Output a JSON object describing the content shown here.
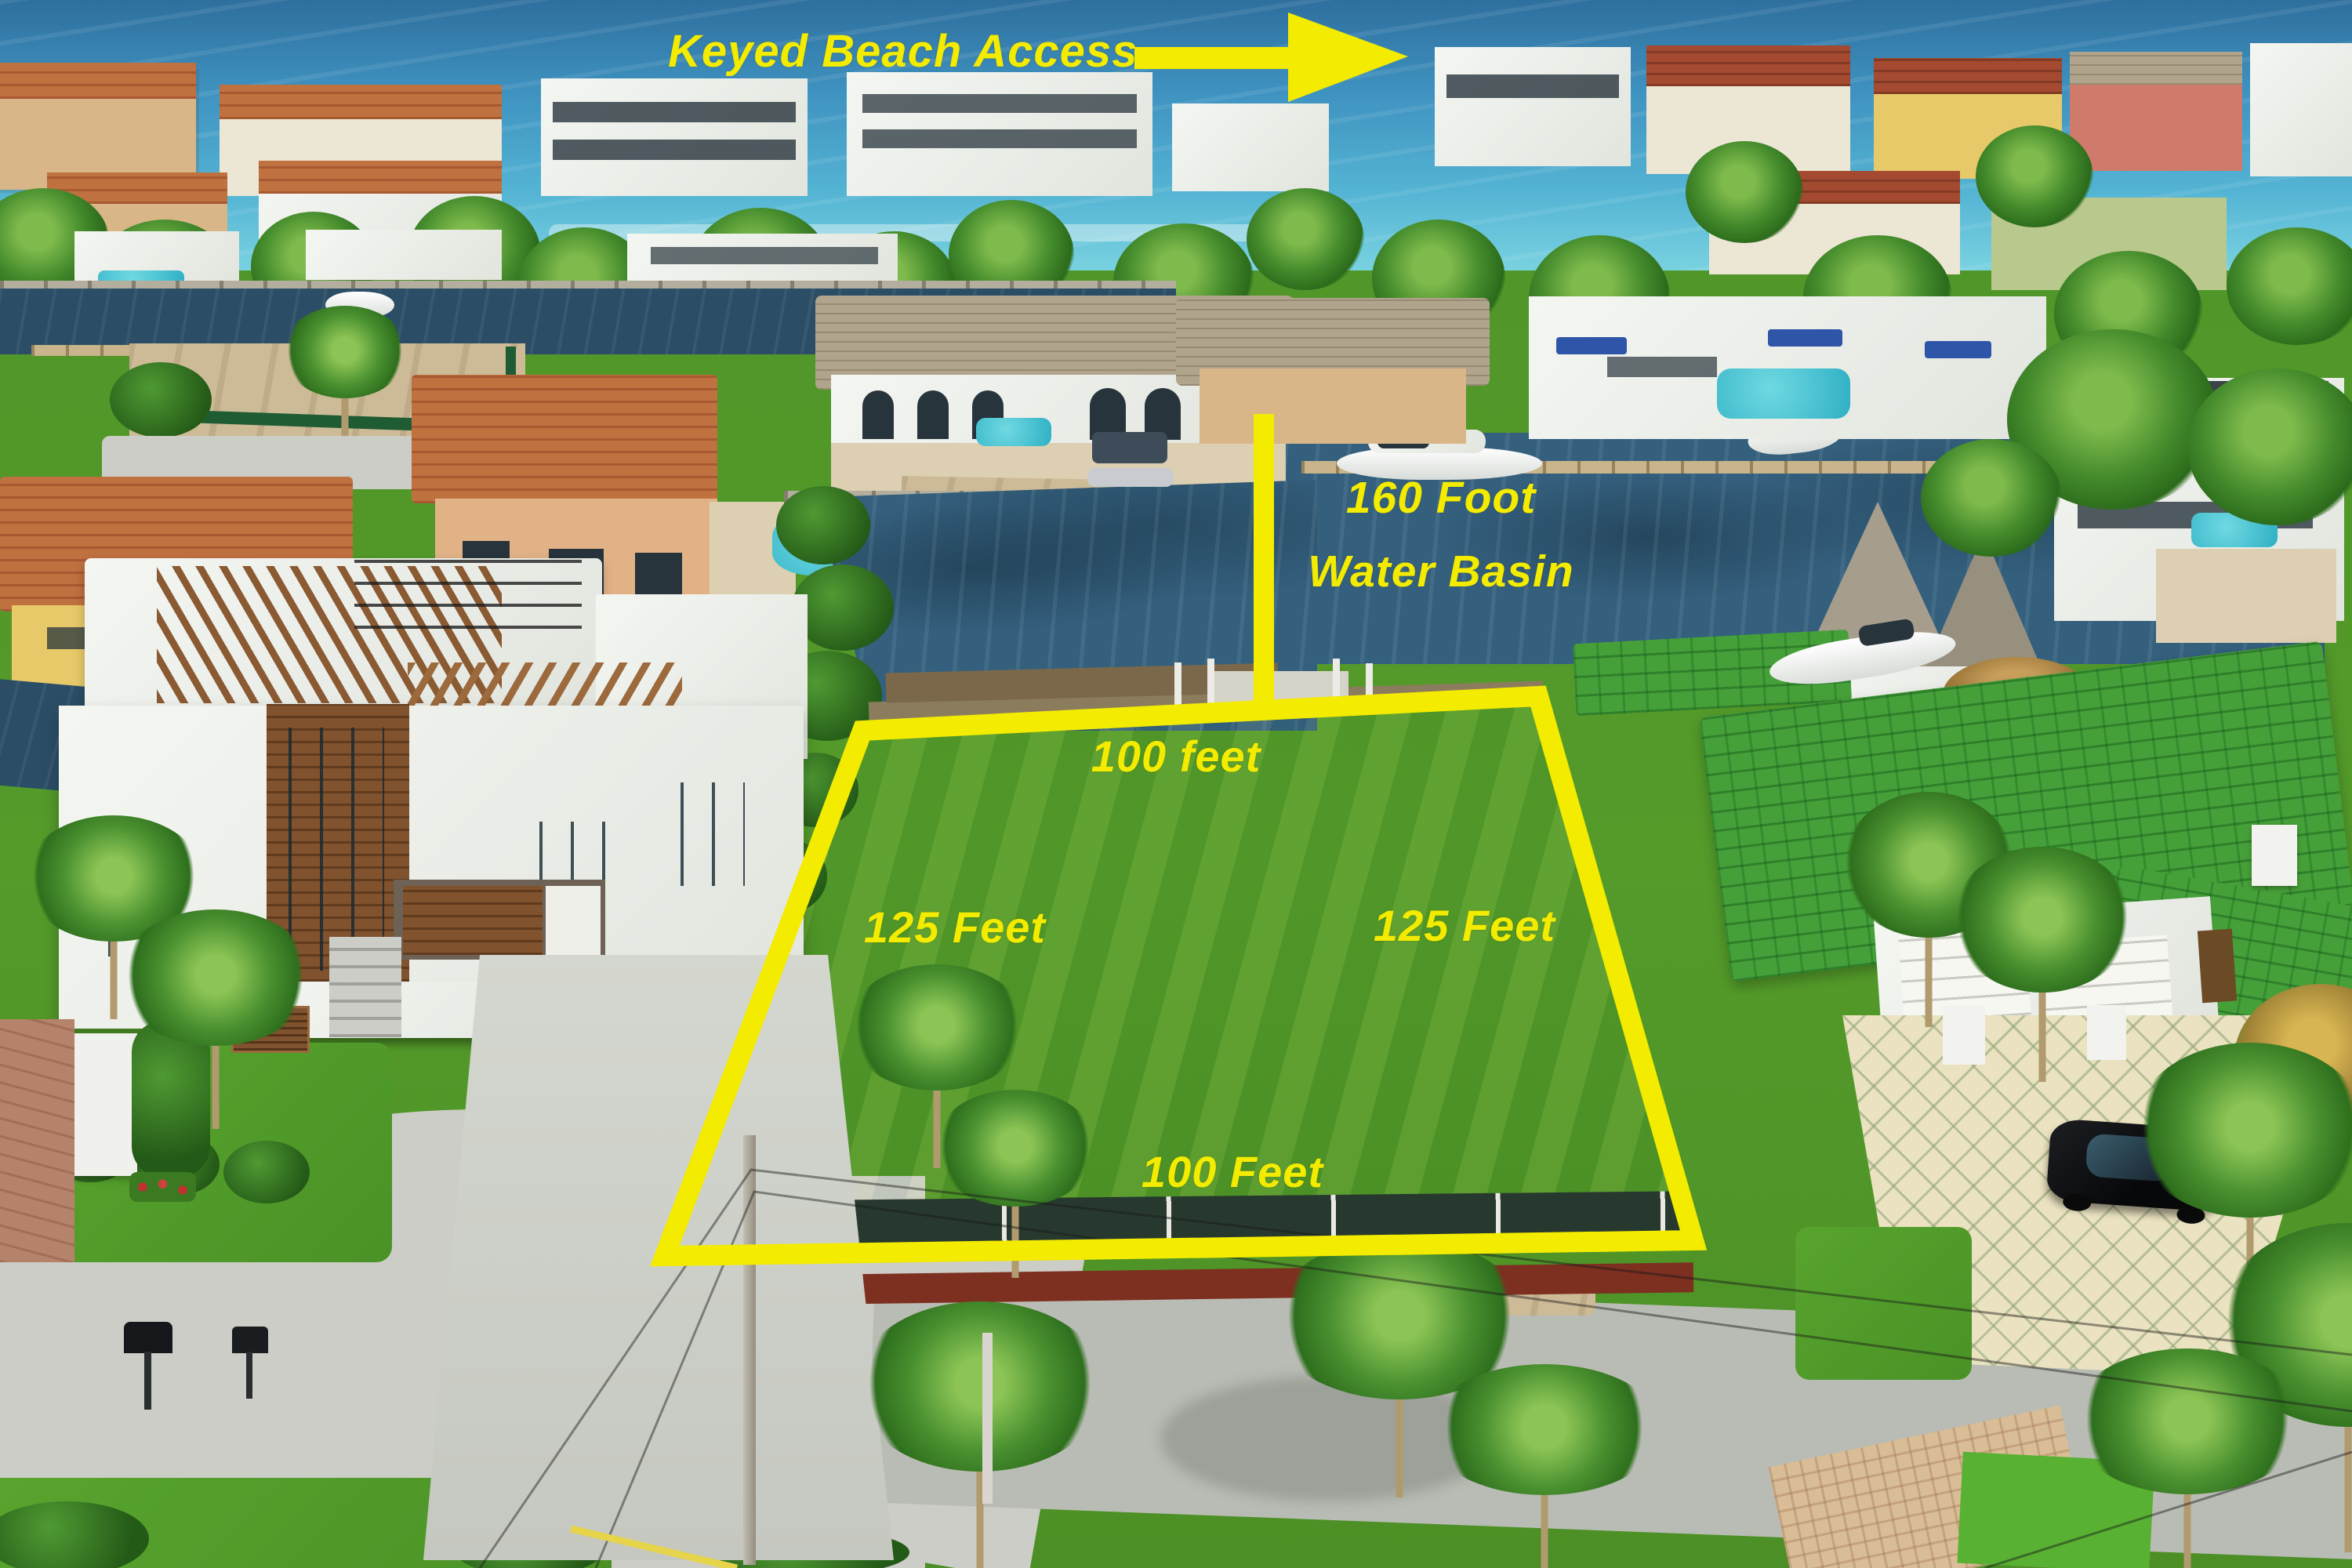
{
  "annotations": {
    "beach_access": {
      "label": "Keyed Beach Access",
      "arrow_icon": "arrow-right"
    },
    "water_basin": {
      "line1": "160 Foot",
      "line2": "Water Basin"
    },
    "lot_dimensions": {
      "top": "100 feet",
      "left": "125 Feet",
      "right": "125 Feet",
      "bottom": "100 Feet"
    }
  },
  "colors": {
    "annotation_yellow": "#F3EB00",
    "ocean": "#3F93C1",
    "canal_water": "#2B4E66",
    "basin_water": "#34607E",
    "lot_grass": "#6FB32F",
    "lawn_green": "#4E9428",
    "green_roof": "#46A039",
    "road_concrete": "#C7C9C2"
  }
}
